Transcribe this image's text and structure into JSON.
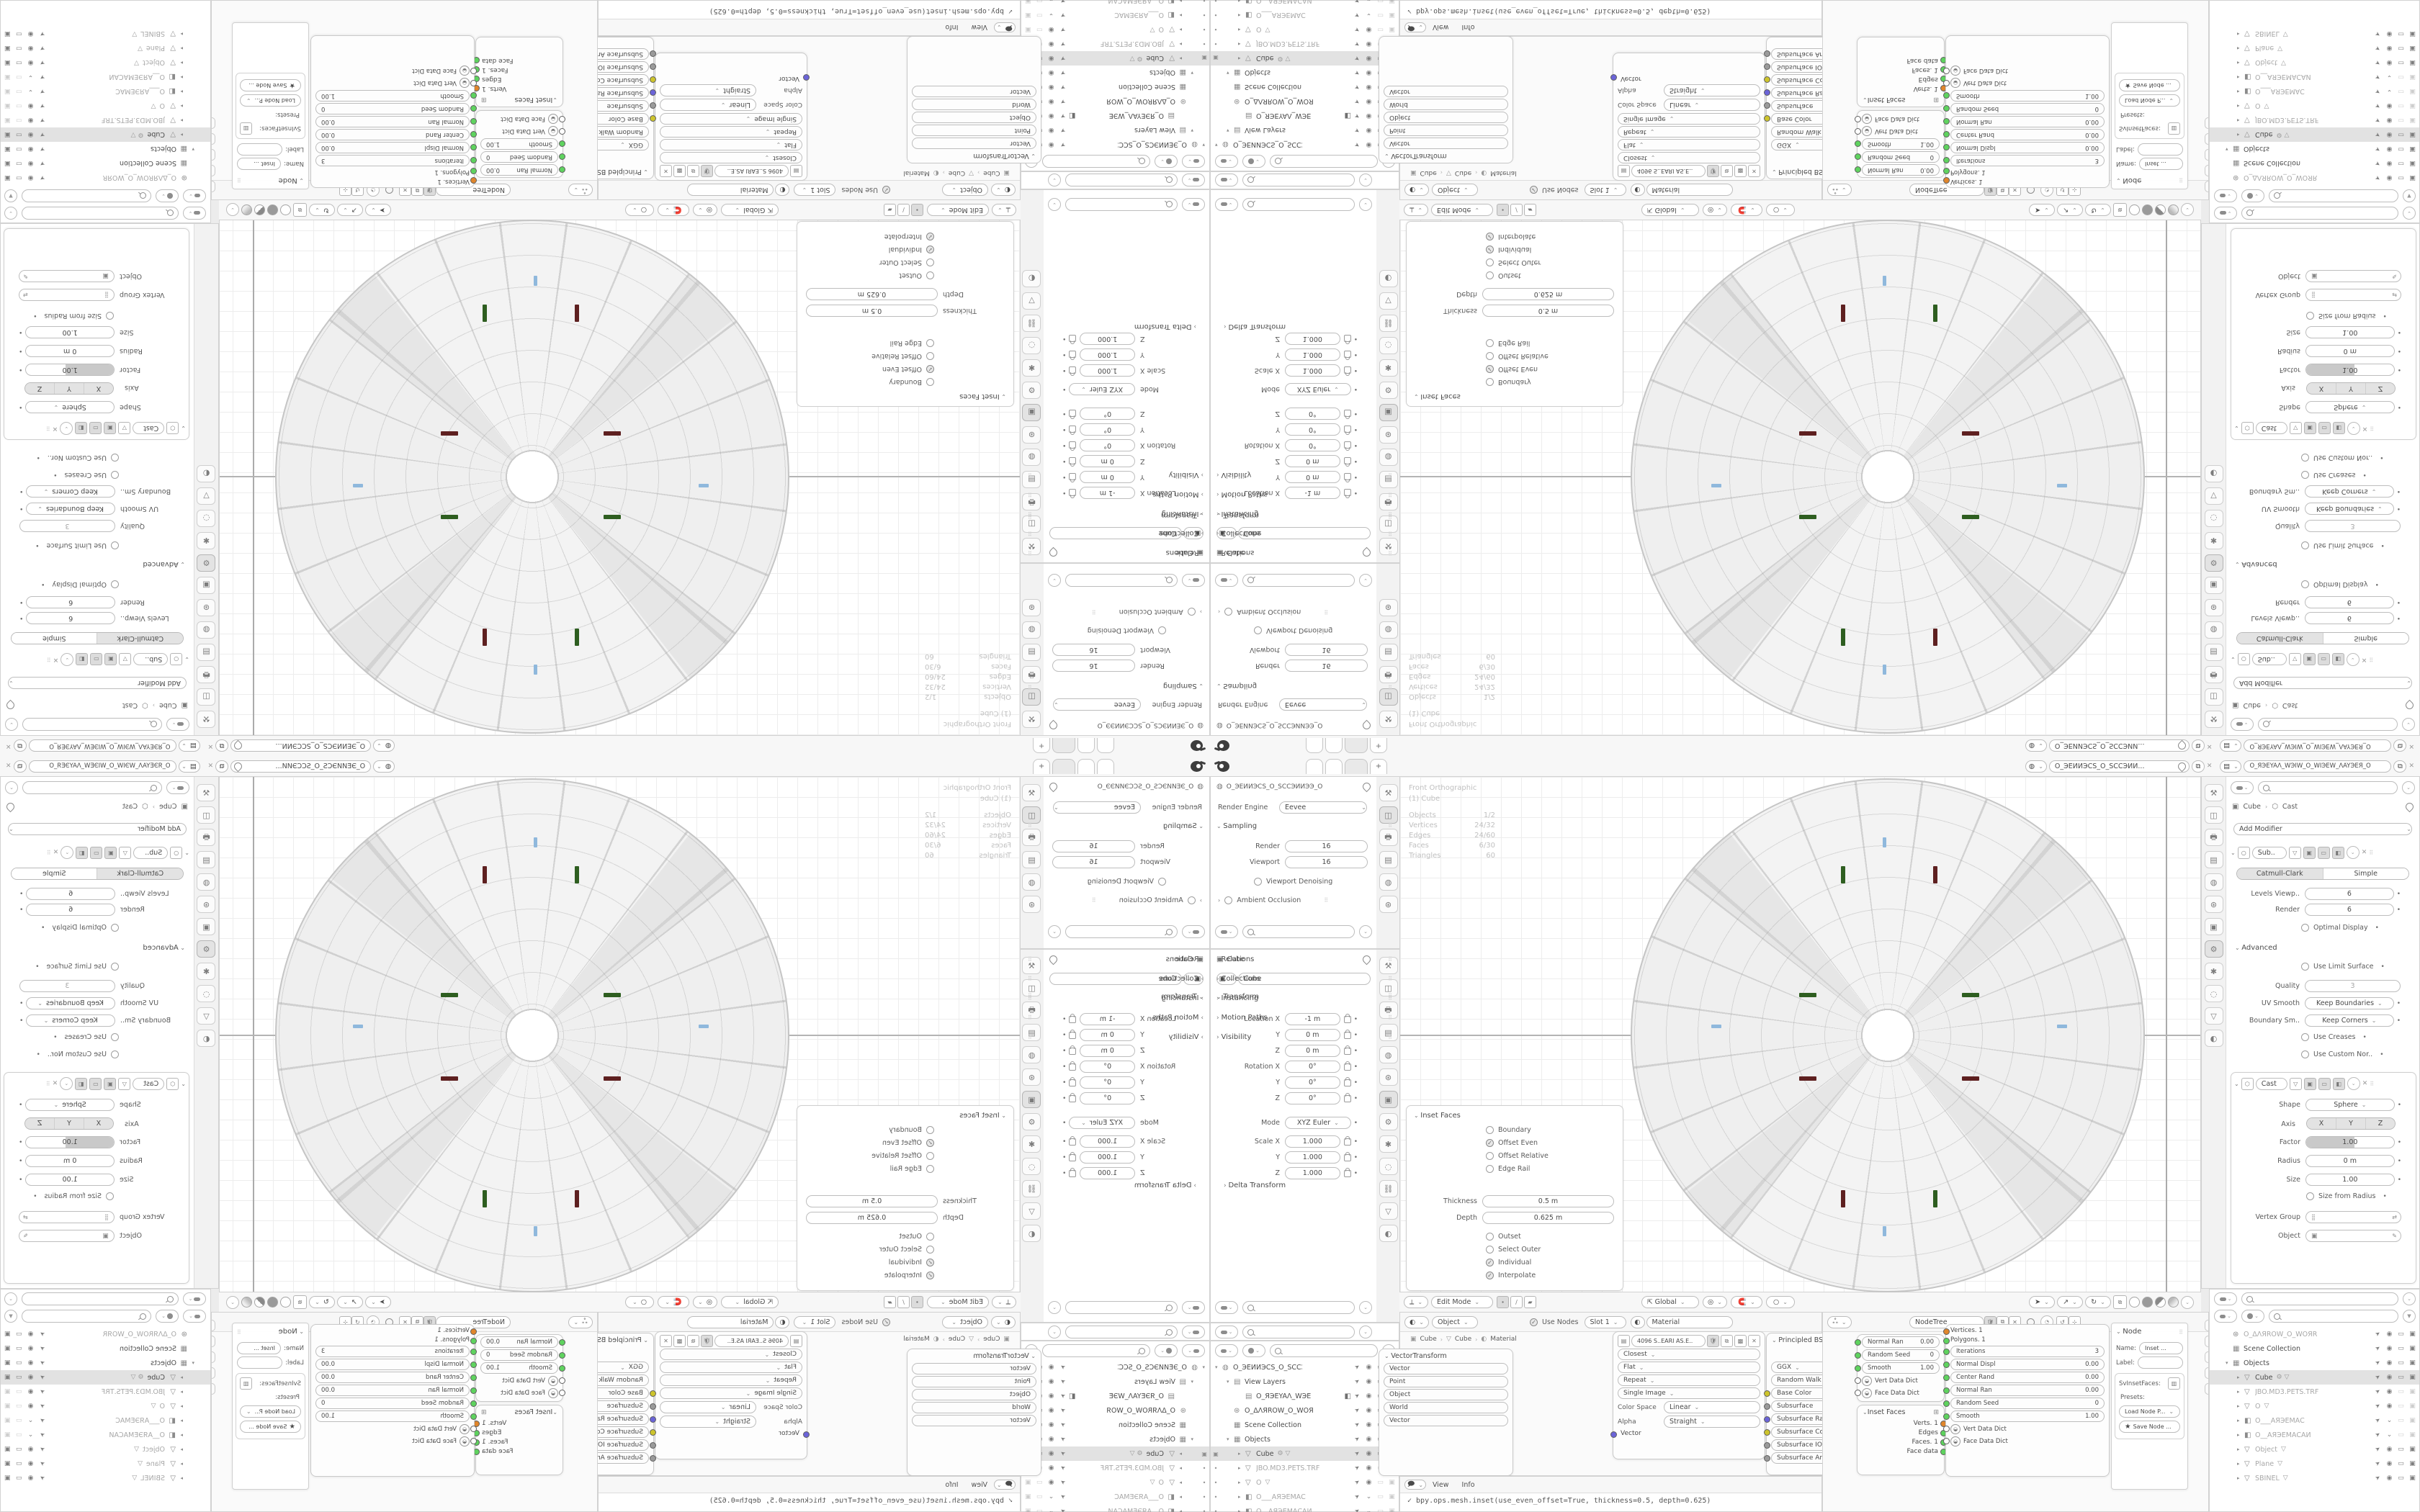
{
  "colors": {
    "accent_green": "#2e5e20",
    "accent_maroon": "#5e2020",
    "accent_blue": "#8fb8dc",
    "highlight_row": "#e2e2e2",
    "socket_green": "#5fd35f",
    "socket_orange": "#e0862c",
    "socket_yellow": "#cdc42c",
    "socket_blue": "#6b64d8"
  },
  "topbar": {
    "menus": [
      "File",
      "Edit",
      "Render",
      "Window",
      "Help"
    ],
    "tab_add": "+",
    "scene_name": "O_ЭЕИИЭCS_O_SCCЭИИ...",
    "viewlayer_name": "O_ЯЭЕYAΛ_WЭIW_O_WIЭEW_ΛAYЭЕЯ_O"
  },
  "props_render": {
    "breadcrumb": "O_ЭЕИИЭCS_O_SCCЭИИЭЭ_O",
    "engine_label": "Render Engine",
    "engine_value": "Eevee",
    "sampling_title": "Sampling",
    "rows": [
      {
        "l": "Render",
        "v": "16"
      },
      {
        "l": "Viewport",
        "v": "16"
      }
    ],
    "denoise_label": "Viewport Denoising",
    "ao_label": "Ambient Occlusion"
  },
  "props_object": {
    "breadcrumb": "Cube",
    "name_value": "Cube",
    "transform_title": "Transform",
    "rows": [
      {
        "l": "Location X",
        "v": "-1 m"
      },
      {
        "l": "Y",
        "v": "0 m"
      },
      {
        "l": "Z",
        "v": "0 m"
      },
      {
        "l": "Rotation X",
        "v": "0°"
      },
      {
        "l": "Y",
        "v": "0°"
      },
      {
        "l": "Z",
        "v": "0°"
      }
    ],
    "mode_label": "Mode",
    "mode_value": "XYZ Euler",
    "scale_rows": [
      {
        "l": "Scale X",
        "v": "1.000"
      },
      {
        "l": "Y",
        "v": "1.000"
      },
      {
        "l": "Z",
        "v": "1.000"
      }
    ],
    "delta": "Delta Transform",
    "collapsed": [
      "Relations",
      "Collections",
      "Instancing",
      "Motion Paths",
      "Visibility"
    ]
  },
  "outliner1": {
    "rows": [
      {
        "ind": 0,
        "exp": "▾",
        "icon": "◍",
        "label": "O_ЭЕИИЭCS_O_SCCЭИI"
      },
      {
        "ind": 1,
        "exp": "▾",
        "icon": "▤",
        "label": "View Layers"
      },
      {
        "ind": 2,
        "exp": "",
        "icon": "▤",
        "label": "O_ЯЭЕYAΛ_WЭЕ",
        "cam": 1
      },
      {
        "ind": 1,
        "exp": "",
        "icon": "⊛",
        "label": "O_ΔΛЯROW_O_WOЯI"
      },
      {
        "ind": 1,
        "exp": "",
        "icon": "▦",
        "label": "Scene Collection"
      },
      {
        "ind": 1,
        "exp": "▾",
        "icon": "▦",
        "label": "Objects"
      },
      {
        "ind": 2,
        "exp": "▸",
        "icon": "▽",
        "label": "Cube",
        "hl": 1,
        "gut": "▣",
        "extra": "⚙ ▽",
        "ic": "full"
      },
      {
        "ind": 2,
        "exp": "▸",
        "icon": "▽",
        "label": "JBO.MD3.PETS.TRF",
        "grey": 1,
        "gut": "•",
        "ic": "off"
      },
      {
        "ind": 2,
        "exp": "▸",
        "icon": "▽",
        "label": "O",
        "grey": 1,
        "gut": "•",
        "extra": "▽",
        "ic": "off"
      },
      {
        "ind": 2,
        "exp": "▸",
        "icon": "◧",
        "label": "O___АЯЭЕМАC",
        "grey": 1,
        "gut": "•",
        "ic": "chev"
      },
      {
        "ind": 2,
        "exp": "▸",
        "icon": "◧",
        "label": "O__АЯЭЕМАCАИ",
        "grey": 1,
        "gut": "•",
        "ic": "chev"
      }
    ]
  },
  "outliner2": {
    "rows": [
      {
        "ind": 1,
        "exp": "",
        "icon": "⊛",
        "label": "O_ΔΛЯROW_O_WOЯR",
        "grey": 1
      },
      {
        "ind": 1,
        "exp": "",
        "icon": "▦",
        "label": "Scene Collection"
      },
      {
        "ind": 1,
        "exp": "▾",
        "icon": "▦",
        "label": "Objects"
      },
      {
        "ind": 2,
        "exp": "▸",
        "icon": "▽",
        "label": "Cube",
        "hl": 1,
        "extra": "⚙ ▽",
        "ic": "full"
      },
      {
        "ind": 2,
        "exp": "▸",
        "icon": "▽",
        "label": "JBO.MD3.PETS.TRF",
        "grey": 1,
        "ic": "off"
      },
      {
        "ind": 2,
        "exp": "▸",
        "icon": "▽",
        "label": "O",
        "grey": 1,
        "extra": "▽",
        "ic": "off"
      },
      {
        "ind": 2,
        "exp": "▸",
        "icon": "◧",
        "label": "O___АЯЭЕМАC",
        "grey": 1,
        "ic": "chev"
      },
      {
        "ind": 2,
        "exp": "▸",
        "icon": "◧",
        "label": "O__АЯЭЕМАCАИ",
        "grey": 1,
        "ic": "chev"
      },
      {
        "ind": 2,
        "exp": "▸",
        "icon": "▽",
        "label": "Object",
        "grey": 1,
        "extra": "▽",
        "ic": "full"
      },
      {
        "ind": 2,
        "exp": "▸",
        "icon": "▽",
        "label": "Plane",
        "grey": 1,
        "extra": "▽",
        "ic": "full"
      },
      {
        "ind": 2,
        "exp": "▸",
        "icon": "▽",
        "label": "SBINEL",
        "grey": 1,
        "extra": "▽",
        "ic": "full"
      }
    ]
  },
  "viewport": {
    "overlay_line1": "Front Orthographic",
    "overlay_line2": "(1) Cube",
    "stats": [
      {
        "l": "Objects",
        "v": "1/2"
      },
      {
        "l": "Vertices",
        "v": "24/32"
      },
      {
        "l": "Edges",
        "v": "24/60"
      },
      {
        "l": "Faces",
        "v": "6/30"
      },
      {
        "l": "Triangles",
        "v": "60"
      }
    ],
    "mode": "Edit Mode",
    "menus": [
      "View",
      "Select",
      "Add",
      "Mesh",
      "Vertex",
      "Edge",
      "Face",
      "UV"
    ],
    "orientation": "Global"
  },
  "inset_panel": {
    "title": "Inset Faces",
    "checks1": [
      {
        "l": "Boundary"
      },
      {
        "l": "Offset Even",
        "c": 1
      },
      {
        "l": "Offset Relative"
      },
      {
        "l": "Edge Rail"
      }
    ],
    "fields": [
      {
        "l": "Thickness",
        "v": "0.5 m"
      },
      {
        "l": "Depth",
        "v": "0.625 m"
      }
    ],
    "checks2": [
      {
        "l": "Outset"
      },
      {
        "l": "Select Outer"
      },
      {
        "l": "Individual",
        "c": 1
      },
      {
        "l": "Interpolate",
        "c": 1
      }
    ]
  },
  "props_mod": {
    "crumb_obj": "Cube",
    "crumb_mod": "Cast",
    "add_label": "Add Modifier",
    "subdiv": {
      "name": "Sub..",
      "seg": [
        "Catmull-Clark",
        "Simple"
      ],
      "vals": [
        {
          "l": "Levels Viewp..",
          "v": "6"
        },
        {
          "l": "Render",
          "v": "6"
        }
      ],
      "check_optimal": "Optimal Display",
      "advanced": "Advanced",
      "limit": "Use Limit Surface",
      "quality_l": "Quality",
      "quality_v": "3",
      "uv_l": "UV Smooth",
      "uv_v": "Keep Boundaries",
      "bs_l": "Boundary Sm..",
      "bs_v": "Keep Corners",
      "creases": "Use Creases",
      "normals": "Use Custom Nor.."
    },
    "cast": {
      "name": "Cast",
      "shape_l": "Shape",
      "shape_v": "Sphere",
      "axis_l": "Axis",
      "axis": [
        "X",
        "Y",
        "Z"
      ],
      "factor_l": "Factor",
      "factor_v": "1.00",
      "radius_l": "Radius",
      "radius_v": "0 m",
      "size_l": "Size",
      "size_v": "1.00",
      "sfr": "Size from Radius",
      "vg_l": "Vertex Group",
      "obj_l": "Object"
    }
  },
  "shader": {
    "type_value": "Object",
    "menus": [
      "View",
      "Select",
      "Add",
      "Node"
    ],
    "use_nodes": "Use Nodes",
    "slot": "Slot 1",
    "material": "Material",
    "crumb": [
      "Cube",
      "Cube",
      "Material"
    ],
    "vt_rows": [
      "Vector",
      "Point",
      "Object",
      "World",
      "Vector"
    ],
    "img": {
      "name": "4096 S..EARI AS.E..",
      "drops": [
        "Closest",
        "Flat",
        "Repeat",
        "Single Image"
      ],
      "cs_l": "Color Space",
      "cs_v": "Linear",
      "a_l": "Alpha",
      "a_v": "Straight",
      "sock": "Vector"
    },
    "bsdf": {
      "title": "Principled BSDF",
      "drops": [
        "GGX",
        "Random Walk"
      ],
      "rows": [
        {
          "l": "Base Color",
          "s": "y",
          "f": 0
        },
        {
          "l": "Subsurface",
          "s": "gr",
          "f": 1
        },
        {
          "l": "Subsurface Radi..",
          "s": "b",
          "f": 1
        },
        {
          "l": "Subsurface Color",
          "s": "y",
          "f": 0
        },
        {
          "l": "Subsurface IOR",
          "s": "gr",
          "f": 1
        },
        {
          "l": "Subsurface Anis..",
          "s": "gr",
          "f": 1
        }
      ]
    }
  },
  "sverchok": {
    "menus": [
      "View",
      "Select",
      "Add",
      "Node"
    ],
    "tree_name": "NodeTree",
    "nodeA": {
      "pills": [
        {
          "l": "Normal Ran",
          "v": "0.00"
        },
        {
          "l": "Random Seed",
          "v": "0"
        },
        {
          "l": "Smooth",
          "v": "1.00"
        }
      ],
      "dicts": [
        "Vert Data Dict",
        "Face Data Dict"
      ]
    },
    "nodeB": {
      "title": "Inset Faces",
      "outs": [
        {
          "l": "Verts. 1",
          "s": "o"
        },
        {
          "l": "Edges",
          "s": "g"
        },
        {
          "l": "Faces. 1",
          "s": "g"
        },
        {
          "l": "Face data",
          "s": "g"
        }
      ]
    },
    "nodeC": {
      "tops": [
        {
          "l": "Vertices. 1",
          "s": "o"
        },
        {
          "l": "Polygons. 1",
          "s": "g"
        }
      ],
      "pills": [
        {
          "l": "Iterations",
          "v": "3"
        },
        {
          "l": "Normal Displ",
          "v": "0.00"
        },
        {
          "l": "Center Rand",
          "v": "0.00"
        },
        {
          "l": "Normal Ran",
          "v": "0.00"
        },
        {
          "l": "Random Seed",
          "v": "0"
        },
        {
          "l": "Smooth",
          "v": "1.00"
        }
      ],
      "dicts": [
        "Vert Data Dict",
        "Face Data Dict"
      ]
    },
    "npanel": {
      "title": "Node",
      "name_l": "Name:",
      "name_v": "Inset ...",
      "label_l": "Label:",
      "group": "SvInsetFaces:",
      "presets": "Presets:",
      "load": "Load Node P...",
      "save": "Save Node ..."
    },
    "vtabs": [
      "No",
      "T",
      "Vi",
      "Gro",
      "Sverc"
    ]
  },
  "info": {
    "menu_view": "View",
    "menu_info": "Info",
    "log": "✓ bpy.ops.mesh.inset(use_even_offset=True, thickness=0.5, depth=0.625)"
  }
}
